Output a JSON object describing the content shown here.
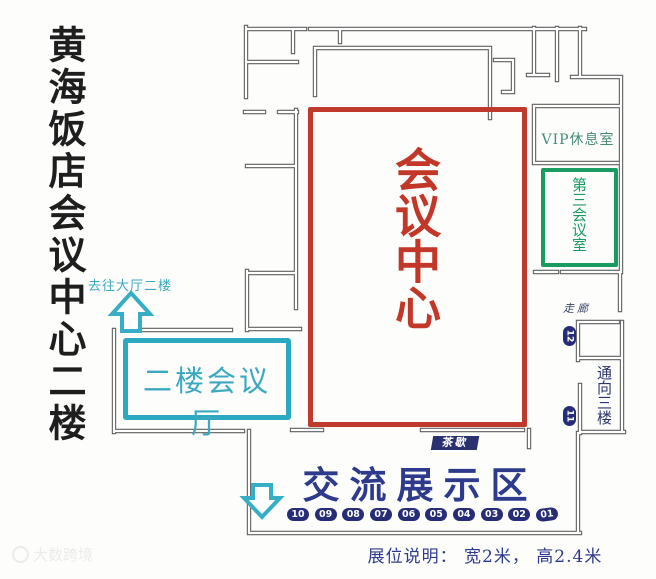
{
  "title": "黄海饭店会议中心二楼",
  "nav": {
    "to_lobby_label": "去往大厅二楼"
  },
  "rooms": {
    "conference_center": "会议中心",
    "vip_lounge": "VIP休息室",
    "third_meeting_room": "第三会议室",
    "second_floor_hall": "二楼会议厅",
    "corridor": "走廊",
    "to_third_floor": "通向三楼"
  },
  "exhibition": {
    "tea_break": "茶歇",
    "area_label": "交流展示区",
    "booths": [
      "10",
      "09",
      "08",
      "07",
      "06",
      "05",
      "04",
      "03",
      "02",
      "01"
    ],
    "side_markers": [
      "12",
      "11"
    ],
    "note": "展位说明： 宽2米， 高2.4米"
  },
  "watermark": "大数跨境",
  "colors": {
    "conference_center_red": "#bf3a2c",
    "hall_teal": "#2ba9c1",
    "third_room_green": "#1a9b61",
    "exhibition_navy": "#2e3a8c",
    "booth_pill_navy": "#272c77",
    "wall_gray": "#5f5f5f",
    "vip_text_green": "#478a78"
  }
}
